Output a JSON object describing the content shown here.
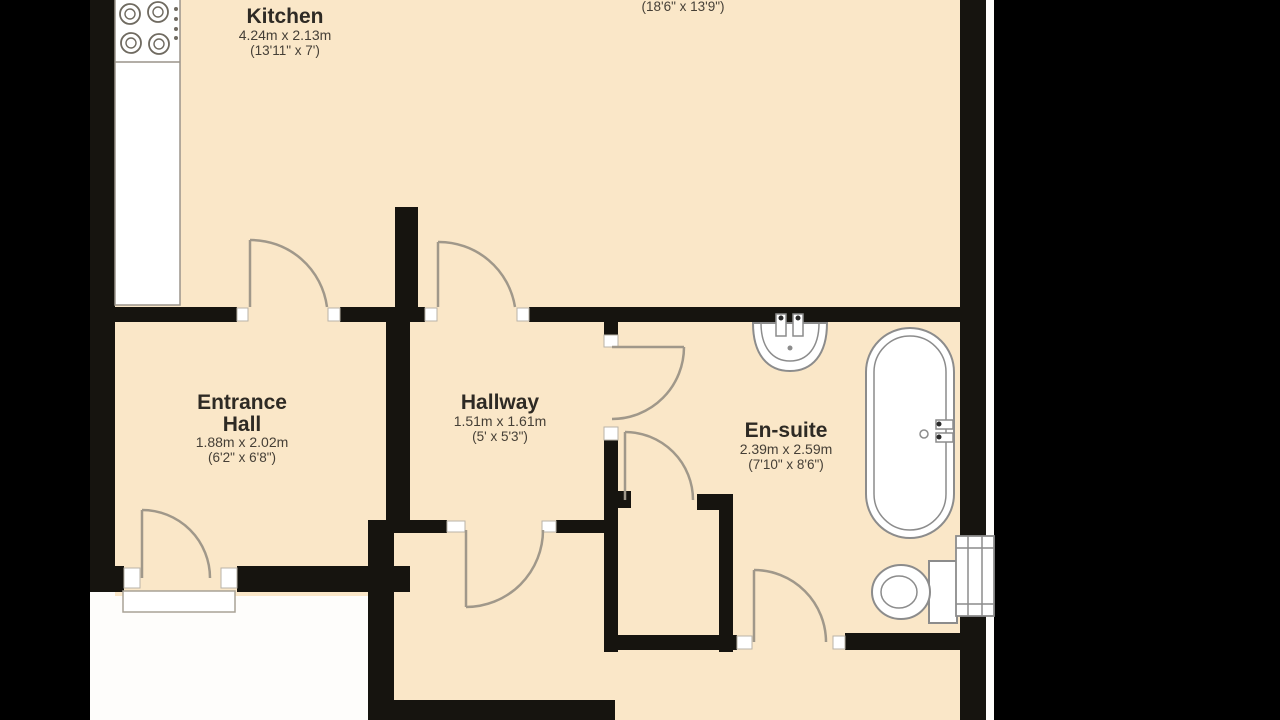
{
  "plan": {
    "type": "floorplan",
    "colors": {
      "background": "#000000",
      "paper": "#fefdfb",
      "room_fill": "#fae7c8",
      "wall": "#16140f",
      "door_arc": "#a0988a",
      "fixture_stroke": "#8c8c8c"
    },
    "rooms": {
      "living_room": {
        "name": "",
        "dims_imperial": "(18'6\" x 13'9\")"
      },
      "kitchen": {
        "name": "Kitchen",
        "dims_metric": "4.24m x 2.13m",
        "dims_imperial": "(13'11\" x 7')"
      },
      "entrance_hall": {
        "name_line1": "Entrance",
        "name_line2": "Hall",
        "dims_metric": "1.88m x 2.02m",
        "dims_imperial": "(6'2\" x 6'8\")"
      },
      "hallway": {
        "name": "Hallway",
        "dims_metric": "1.51m x 1.61m",
        "dims_imperial": "(5' x 5'3\")"
      },
      "en_suite": {
        "name": "En-suite",
        "dims_metric": "2.39m x 2.59m",
        "dims_imperial": "(7'10\" x 8'6\")"
      }
    },
    "fixtures": [
      "hob-4-burners",
      "kitchen-counter",
      "bathtub",
      "wash-basin",
      "toilet",
      "window",
      "entrance-threshold"
    ],
    "door_count": 7
  }
}
